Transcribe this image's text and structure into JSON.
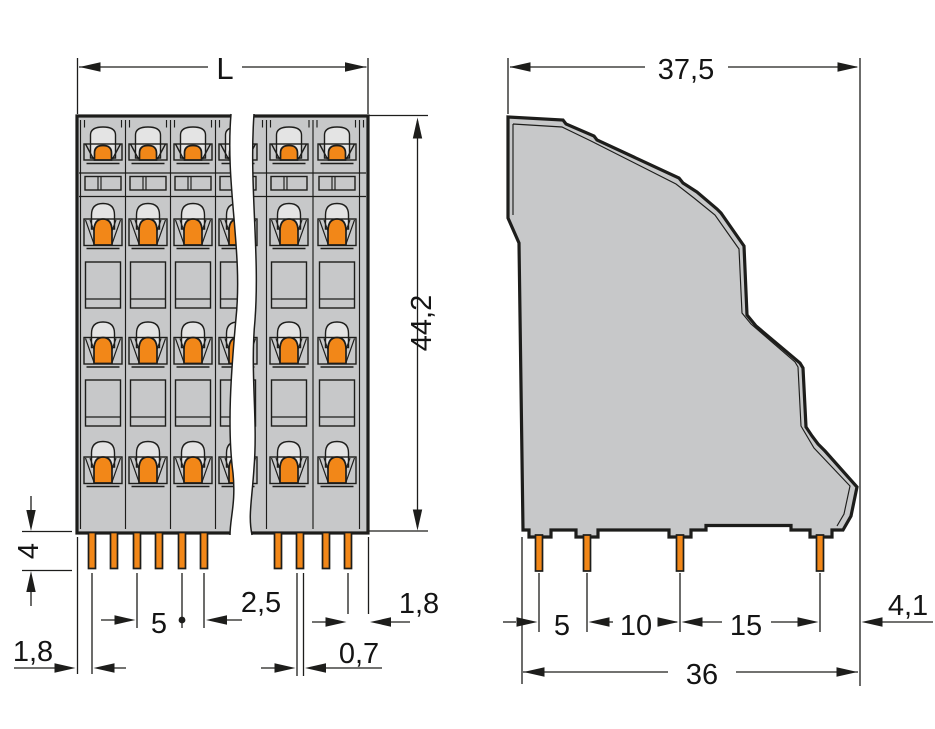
{
  "front_view": {
    "dims": {
      "overall_length": "L",
      "overall_height": "44,2",
      "pin_length": "4",
      "left_edge_to_first_pin": "1,8",
      "pole_pitch": "5",
      "pin_pair_spacing": "2,5",
      "last_pin_to_right_edge": "1,8",
      "pin_width": "0,7"
    }
  },
  "side_view": {
    "dims": {
      "overall_depth": "37,5",
      "pin_spacing_front": "5",
      "pin_spacing_middle": "10",
      "pin_spacing_back": "15",
      "back_edge_offset": "4,1",
      "pin_field_depth": "36"
    }
  },
  "colors": {
    "housing_gray": "#c7c8c9",
    "clamp_orange": "#f28718",
    "dome_gray": "#e4e4e4",
    "line_black": "#1d1d1b",
    "background": "#ffffff"
  }
}
